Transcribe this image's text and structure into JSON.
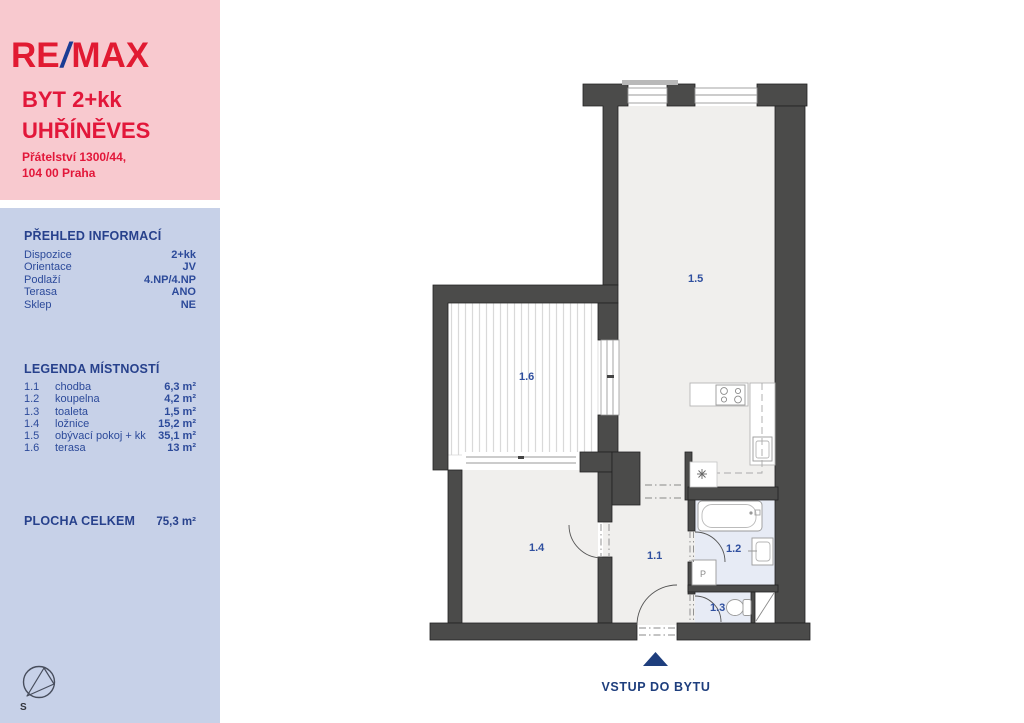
{
  "listing": {
    "logo": {
      "re": "RE",
      "slash": "/",
      "max": "MAX"
    },
    "title_line1": "BYT 2+kk",
    "title_line2": "UHŘÍNĚVES",
    "address_line1": "Přátelství 1300/44,",
    "address_line2": "104 00 Praha"
  },
  "overview": {
    "heading": "PŘEHLED INFORMACÍ",
    "rows": [
      {
        "label": "Dispozice",
        "value": "2+kk"
      },
      {
        "label": "Orientace",
        "value": "JV"
      },
      {
        "label": "Podlaží",
        "value": "4.NP/4.NP"
      },
      {
        "label": "Terasa",
        "value": "ANO"
      },
      {
        "label": "Sklep",
        "value": "NE"
      }
    ]
  },
  "legend": {
    "heading": "LEGENDA MÍSTNOSTÍ",
    "rows": [
      {
        "id": "1.1",
        "name": "chodba",
        "area": "6,3 m²"
      },
      {
        "id": "1.2",
        "name": "koupelna",
        "area": "4,2 m²"
      },
      {
        "id": "1.3",
        "name": "toaleta",
        "area": "1,5 m²"
      },
      {
        "id": "1.4",
        "name": "ložnice",
        "area": "15,2 m²"
      },
      {
        "id": "1.5",
        "name": "obývací pokoj + kk",
        "area": "35,1 m²"
      },
      {
        "id": "1.6",
        "name": "terasa",
        "area": "13 m²"
      }
    ]
  },
  "total": {
    "label": "PLOCHA CELKEM",
    "value": "75,3 m²"
  },
  "plan": {
    "room_labels": {
      "r11": "1.1",
      "r12": "1.2",
      "r13": "1.3",
      "r14": "1.4",
      "r15": "1.5",
      "r16": "1.6"
    },
    "entrance_label": "VSTUP DO BYTU",
    "washer_label": "P",
    "compass_label": "S"
  },
  "colors": {
    "remax_red": "#e11a32",
    "remax_blue": "#1a3c94",
    "accent_navy": "#27418c",
    "panel_pink": "#f8c9cf",
    "panel_blue": "#c7d1e8",
    "wall_gray": "#4b4b4a",
    "floor_gray": "#f0efed",
    "wet_room_blue": "#e7ebf5"
  }
}
